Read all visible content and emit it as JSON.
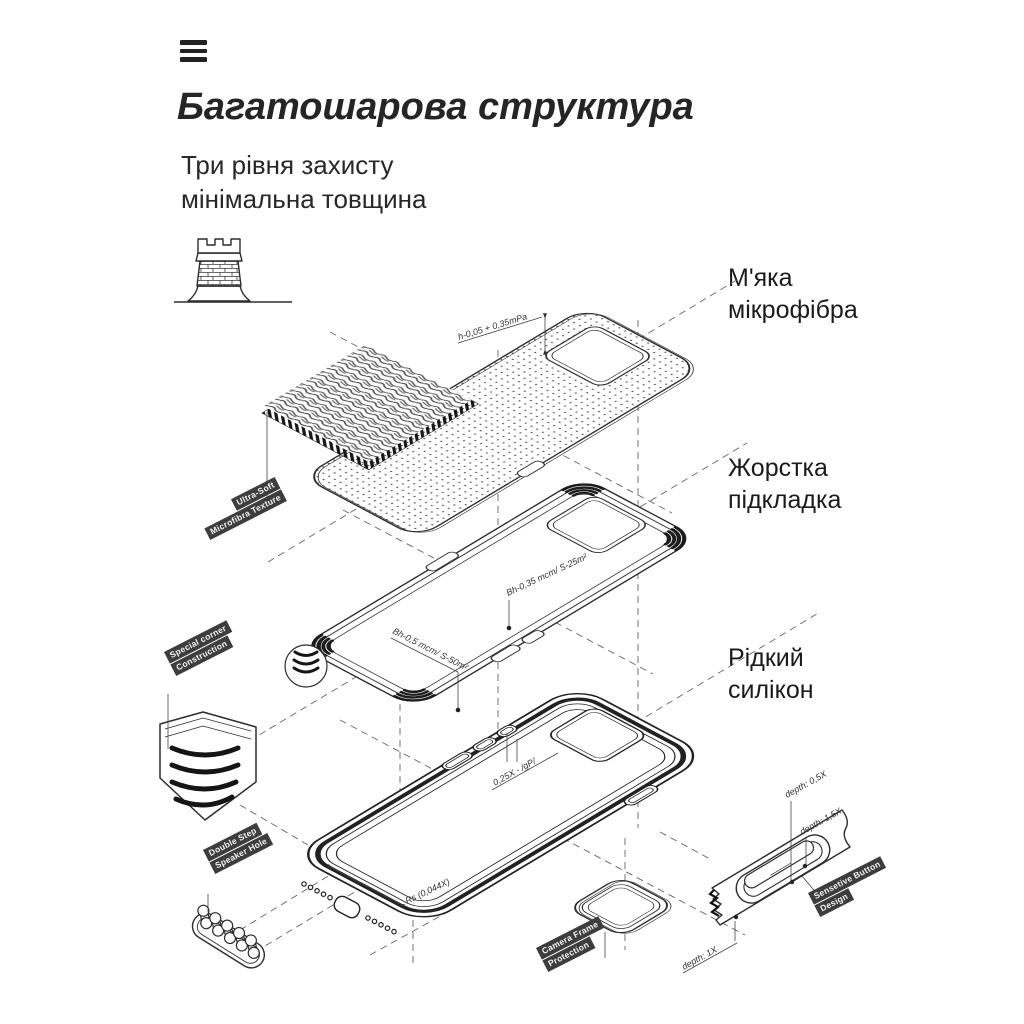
{
  "header": {
    "menu_icon": "hamburger-menu",
    "title": "Багатошарова структура",
    "subtitle_line1": "Три рівня захисту",
    "subtitle_line2": "мінімальна товщина"
  },
  "layer_labels": {
    "microfiber_line1": "М'яка",
    "microfiber_line2": "мікрофібра",
    "lining_line1": "Жорстка",
    "lining_line2": "підкладка",
    "silicone_line1": "Рідкий",
    "silicone_line2": "силікон"
  },
  "tags": {
    "ultra_soft": {
      "line1": "Ultra-Soft",
      "line2": "Microfibra Texture"
    },
    "special_corner": {
      "line1": "Special corner",
      "line2": "Construction"
    },
    "double_step": {
      "line1": "Double Step",
      "line2": "Speaker Hole"
    },
    "camera_frame": {
      "line1": "Camera Frame",
      "line2": "Protection"
    },
    "sensitive_button": {
      "line1": "Sensetive Button",
      "line2": "Design"
    }
  },
  "annotations": {
    "thickness_top": "h-0,05 + 0,35mPa",
    "roughness_inner": "Bh-0,35 mcm/ S-25m²",
    "roughness_outer": "Bh-0,5 mcm/ S-50m²",
    "button_ratio": "0,25X - /gP/",
    "corner_radius": "Rs (0,044X)",
    "depth_05": "depth: 0,5X",
    "depth_15": "depth: 1,5X",
    "depth_1": "depth: 1X"
  },
  "icons": {
    "tower": "castle-tower-icon",
    "menu": "hamburger-menu-icon"
  },
  "colors": {
    "ink": "#2d2d2d",
    "tag_bg": "#3d3d3d",
    "text": "#1b1b1b",
    "dashed": "#666666",
    "background": "#ffffff"
  }
}
